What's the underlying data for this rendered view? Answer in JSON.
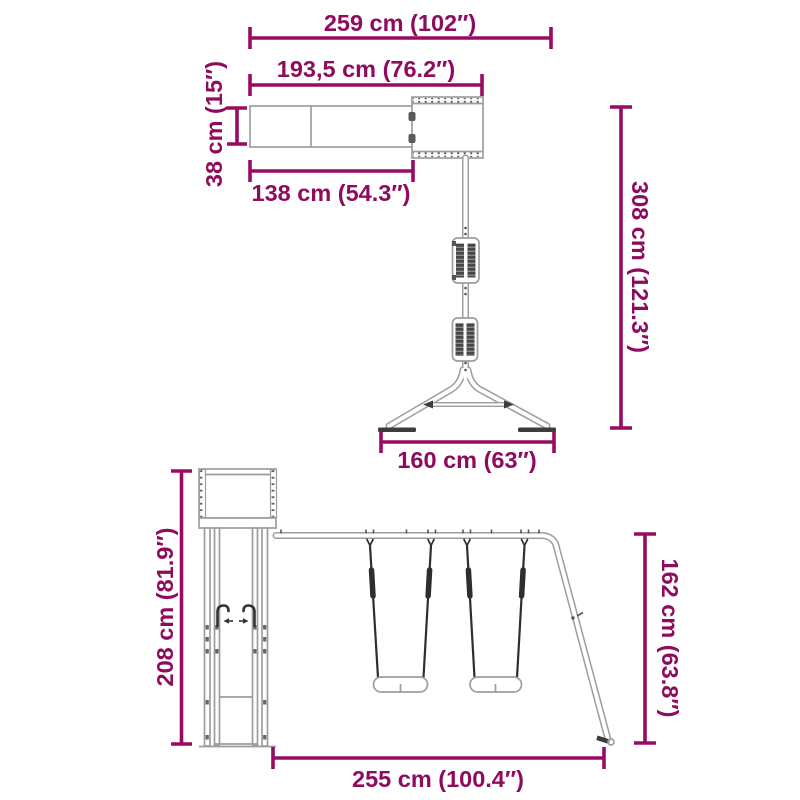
{
  "diagram": {
    "type": "product-dimension-drawing",
    "subject": "wooden playset with monkey bar swing arm, play tower, slide and double swing",
    "colors": {
      "dimension_lines": "#970c62",
      "dimension_text": "#8f0b5d",
      "structure_outline": "#9d9d9d",
      "structure_dark_parts": "#3c3c3c",
      "background": "#ffffff"
    },
    "top_view": {
      "dimensions": {
        "overall_width": "259 cm (102″)",
        "beam_length": "193,5 cm (76.2″)",
        "beam_depth": "38 cm (15″)",
        "monkey_bar_length": "138 cm (54.3″)",
        "overall_length": "308 cm (121.3″)",
        "base_width": "160 cm (63″)"
      }
    },
    "front_view": {
      "dimensions": {
        "tower_height": "208 cm (81.9″)",
        "swing_frame_height": "162 cm (63.8″)",
        "swing_section_width": "255 cm (100.4″)"
      }
    }
  }
}
